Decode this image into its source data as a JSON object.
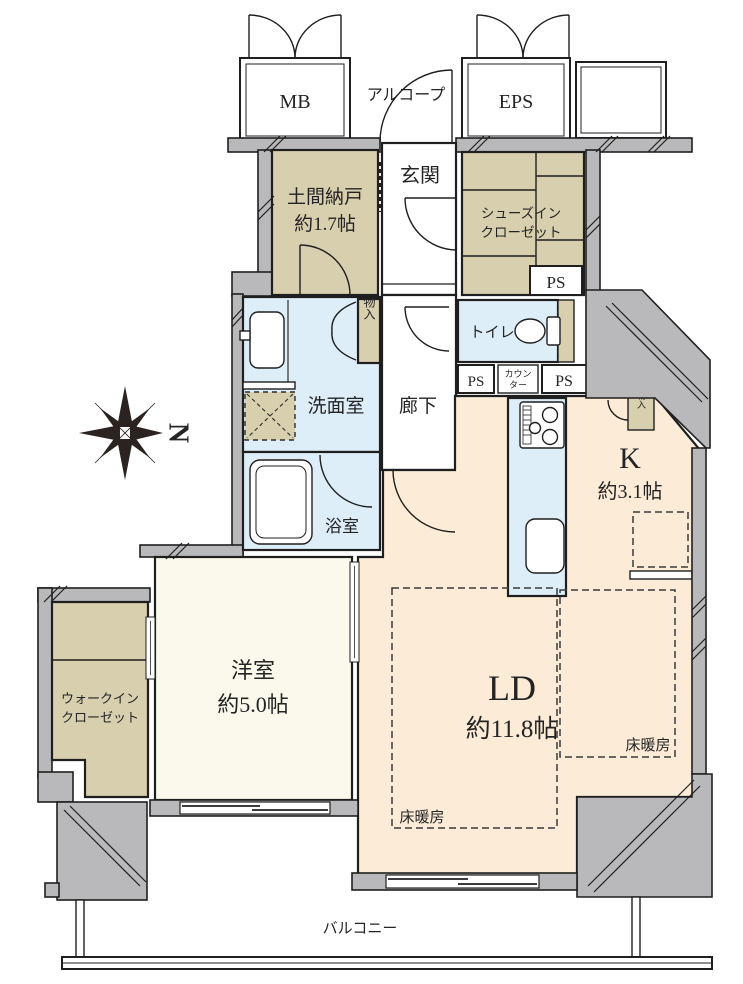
{
  "plan": {
    "top": {
      "mb": "MB",
      "alcove": "アルコープ",
      "eps": "EPS"
    },
    "rooms": {
      "doma_storage": {
        "name": "土間納戸",
        "size": "約1.7帖"
      },
      "genkan": {
        "name": "玄関"
      },
      "shoes_closet": {
        "line1": "シューズイン",
        "line2": "クローゼット"
      },
      "toilet": {
        "name": "トイレ"
      },
      "washroom": {
        "name": "洗面室"
      },
      "hallway": {
        "name": "廊下"
      },
      "bathroom": {
        "name": "浴室"
      },
      "kitchen": {
        "name": "K",
        "size": "約3.1帖"
      },
      "living_dining": {
        "name": "LD",
        "size": "約11.8帖"
      },
      "western_room": {
        "name": "洋室",
        "size": "約5.0帖"
      },
      "walk_in_closet": {
        "line1": "ウォークイン",
        "line2": "クローゼット"
      }
    },
    "labels": {
      "ps": "PS",
      "counter_line1": "カウン",
      "counter_line2": "ター",
      "storage": "物入",
      "floor_heating": "床暖房",
      "balcony": "バルコニー"
    },
    "compass": {
      "north_label": "N"
    },
    "colors": {
      "wall_gray": "#b9b9bb",
      "closet_tan": "#d8cfae",
      "wet_blue": "#ddeef8",
      "ld_cream": "#fcecd7",
      "room_pale": "#fbf9ec",
      "line_dark": "#1f1f1f"
    }
  }
}
